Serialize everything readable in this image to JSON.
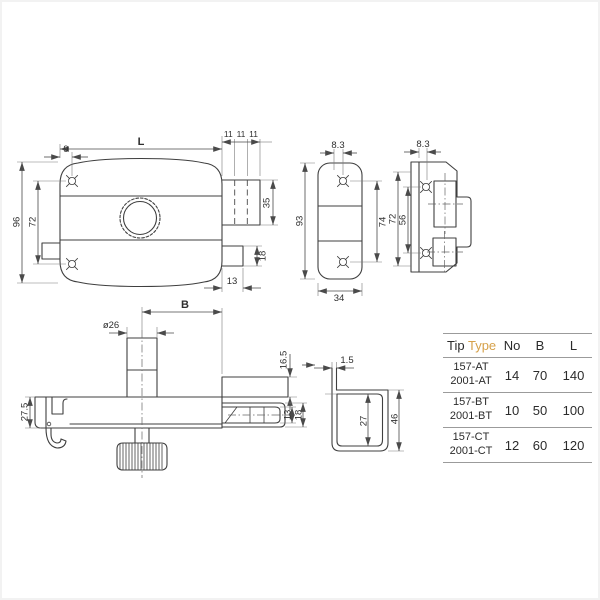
{
  "colors": {
    "line": "#3f3f3f",
    "accent_type": "#d6a14a"
  },
  "drawing": {
    "front": {
      "L": "L",
      "n9": "9",
      "n11a": "11",
      "n11b": "11",
      "n11c": "11",
      "n35": "35",
      "n18": "18",
      "n13": "13",
      "n96": "96",
      "n72": "72"
    },
    "plate": {
      "n83": "8.3",
      "n93": "93",
      "n74": "74",
      "n34": "34"
    },
    "strike": {
      "n83": "8.3",
      "n72": "72",
      "n56": "56"
    },
    "top": {
      "B": "B",
      "d26": "ø26",
      "n165": "16.5",
      "n275": "27.5",
      "n13": "13",
      "n18": "18"
    },
    "box": {
      "n15": "1.5",
      "n27": "27",
      "n46": "46"
    }
  },
  "table": {
    "header": {
      "tip": "Tip",
      "type": "Type",
      "no": "No",
      "b": "B",
      "l": "L"
    },
    "rows": [
      {
        "type_line1": "157-AT",
        "type_line2": "2001-AT",
        "no": "14",
        "b": "70",
        "l": "140"
      },
      {
        "type_line1": "157-BT",
        "type_line2": "2001-BT",
        "no": "10",
        "b": "50",
        "l": "100"
      },
      {
        "type_line1": "157-CT",
        "type_line2": "2001-CT",
        "no": "12",
        "b": "60",
        "l": "120"
      }
    ]
  }
}
